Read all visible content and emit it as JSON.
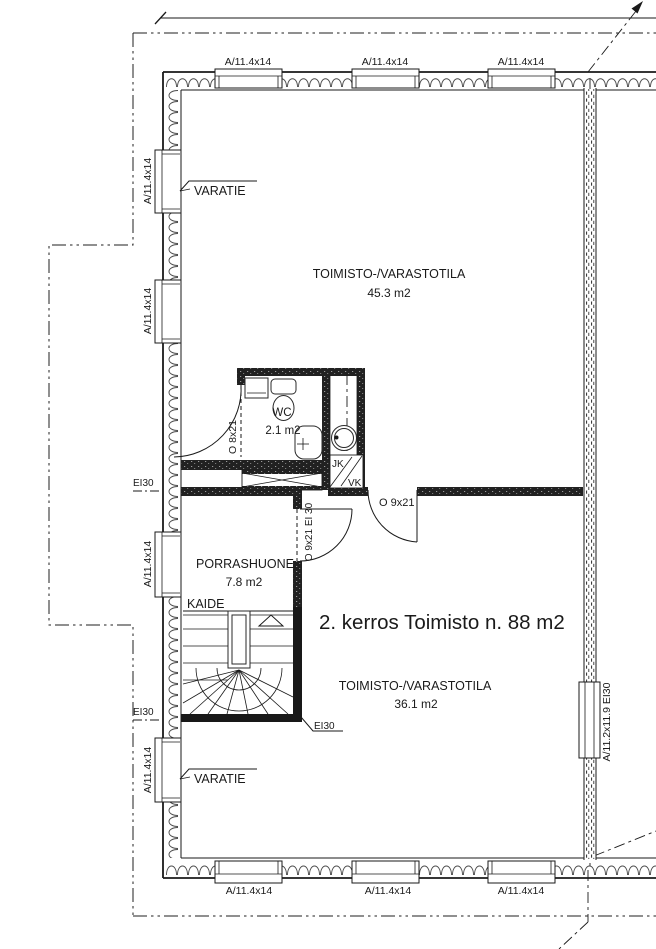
{
  "title": "2. kerros Toimisto n. 88 m2",
  "rooms": {
    "office_top": {
      "name": "TOIMISTO-/VARASTOTILA",
      "area": "45.3 m2"
    },
    "office_bottom": {
      "name": "TOIMISTO-/VARASTOTILA",
      "area": "36.1 m2"
    },
    "stairwell": {
      "name": "PORRASHUONE",
      "area": "7.8 m2"
    },
    "wc": {
      "name": "WC",
      "area": "2.1 m2"
    }
  },
  "doors": {
    "wc_door": "O 8x21",
    "office_door": "O 9x21",
    "stairwell_door": "O 9x21 EI 30"
  },
  "windows": {
    "top": [
      "A/11.4x14",
      "A/11.4x14",
      "A/11.4x14"
    ],
    "bottom": [
      "A/11.4x14",
      "A/11.4x14",
      "A/11.4x14"
    ],
    "left": [
      "A/11.4x14",
      "A/11.4x14",
      "A/11.4x14",
      "A/11.4x14"
    ],
    "right": "A/11.2x11.9 EI30"
  },
  "annotations": {
    "varatie_top": "VARATIE",
    "varatie_bottom": "VARATIE",
    "kaide": "KAIDE",
    "ei30_left_top": "EI30",
    "ei30_left_bottom": "EI30",
    "ei30_stair": "EI30",
    "jk": "JK",
    "vk": "VK"
  },
  "colors": {
    "line": "#1a1a1a",
    "background": "#ffffff"
  }
}
